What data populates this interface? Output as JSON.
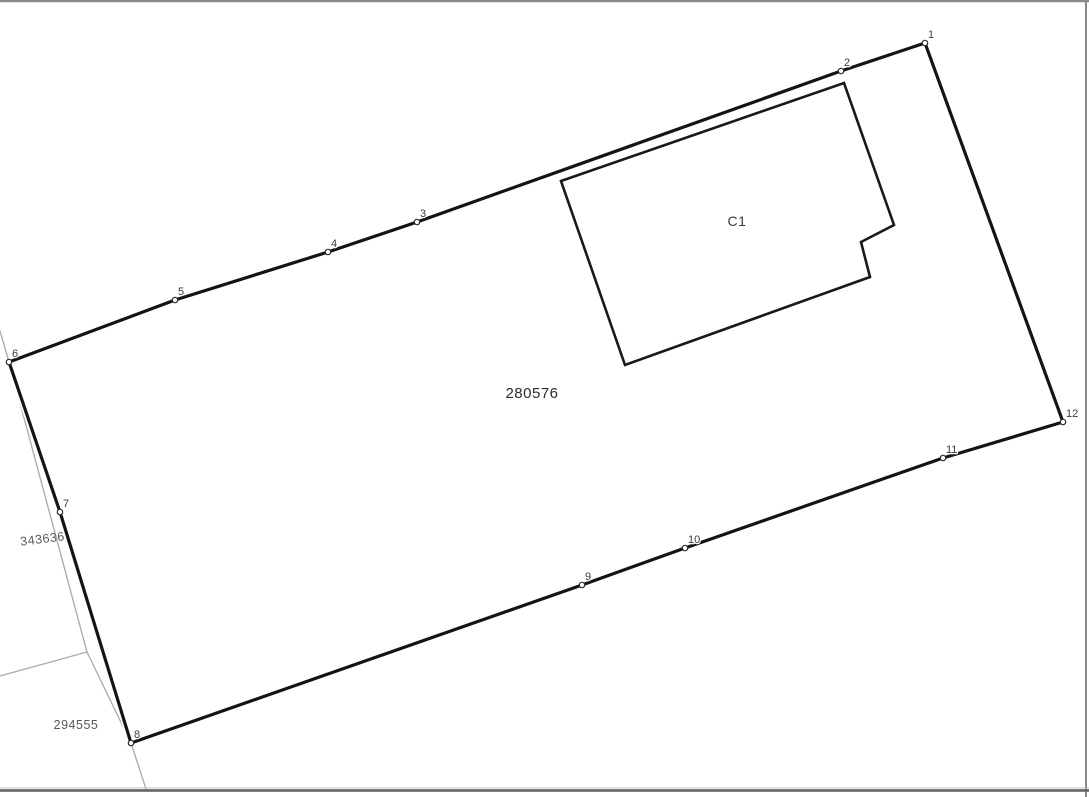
{
  "map": {
    "width": 1089,
    "height": 797,
    "background": "#ffffff",
    "frame_color": "#8a8a8a",
    "bottom_frame_color": "#5f5f5f"
  },
  "parcel": {
    "number": "280576",
    "label_pos": [
      532,
      398
    ],
    "label_color": "#2b2b2b",
    "label_size": 15,
    "stroke_color": "#141414",
    "stroke_width": 3.2,
    "casing_color": "#ffffff",
    "casing_width": 6.5,
    "vertices": [
      {
        "n": "1",
        "x": 925,
        "y": 43
      },
      {
        "n": "2",
        "x": 841,
        "y": 71
      },
      {
        "n": "3",
        "x": 417,
        "y": 222
      },
      {
        "n": "4",
        "x": 328,
        "y": 252
      },
      {
        "n": "5",
        "x": 175,
        "y": 300
      },
      {
        "n": "6",
        "x": 9,
        "y": 362
      },
      {
        "n": "7",
        "x": 60,
        "y": 512
      },
      {
        "n": "8",
        "x": 131,
        "y": 743
      },
      {
        "n": "9",
        "x": 582,
        "y": 585
      },
      {
        "n": "10",
        "x": 685,
        "y": 548
      },
      {
        "n": "11",
        "x": 943,
        "y": 458
      },
      {
        "n": "12",
        "x": 1063,
        "y": 422
      }
    ]
  },
  "building": {
    "label": "C1",
    "label_pos": [
      737,
      226
    ],
    "label_color": "#3b3b3b",
    "label_size": 14,
    "stroke_color": "#191919",
    "stroke_width": 2.6,
    "points": [
      [
        561,
        181
      ],
      [
        844,
        83
      ],
      [
        894,
        225
      ],
      [
        861,
        242
      ],
      [
        870,
        277
      ],
      [
        625,
        365
      ]
    ]
  },
  "neighbors": [
    {
      "number": "343636",
      "label_pos": [
        43,
        543
      ],
      "rotation": -7,
      "color": "#5a5a5a",
      "size": 12.5
    },
    {
      "number": "294555",
      "label_pos": [
        76,
        729
      ],
      "rotation": 0,
      "color": "#5a5a5a",
      "size": 12.5
    }
  ],
  "neighbor_lines": {
    "color": "#aeaeae",
    "width": 1.4,
    "polylines": [
      [
        [
          0,
          331
        ],
        [
          9,
          362
        ]
      ],
      [
        [
          9,
          362
        ],
        [
          87,
          652
        ]
      ],
      [
        [
          87,
          652
        ],
        [
          0,
          676
        ]
      ],
      [
        [
          87,
          652
        ],
        [
          131,
          743
        ]
      ],
      [
        [
          131,
          743
        ],
        [
          146,
          789
        ]
      ]
    ]
  },
  "vertex_marker": {
    "radius": 2.7,
    "fill": "#ffffff",
    "stroke": "#2e2e2e",
    "stroke_width": 1.2,
    "label_color": "#3c3c3c",
    "label_size": 11,
    "label_halo": "#ffffff",
    "label_dx": 3,
    "label_dy": -5
  }
}
